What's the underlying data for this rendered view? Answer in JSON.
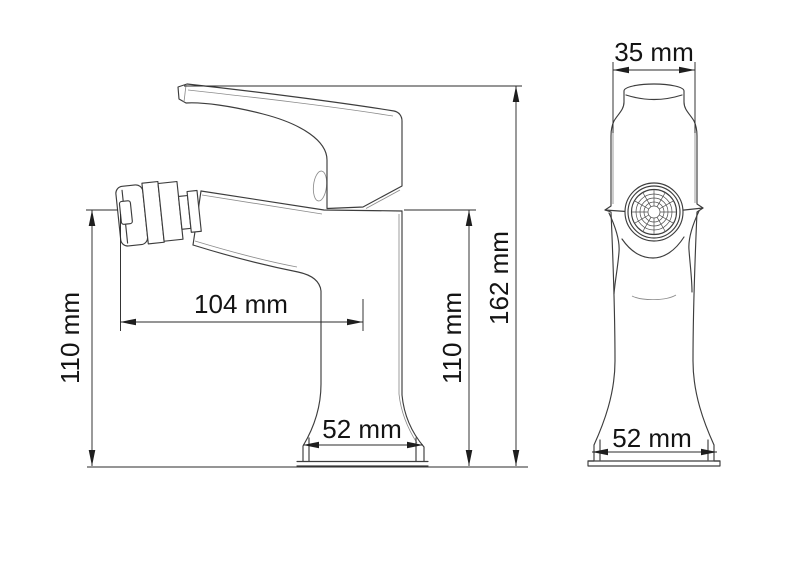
{
  "dims": {
    "top_width": "35 mm",
    "reach": "104 mm",
    "height_left": "110 mm",
    "height_right": "110 mm",
    "total_height": "162 mm",
    "base_side": "52 mm",
    "base_front": "52 mm"
  },
  "colors": {
    "background": "#ffffff",
    "outline": "#3d3d3d",
    "dimension_line": "#2b2b2b",
    "label_text": "#141414"
  }
}
